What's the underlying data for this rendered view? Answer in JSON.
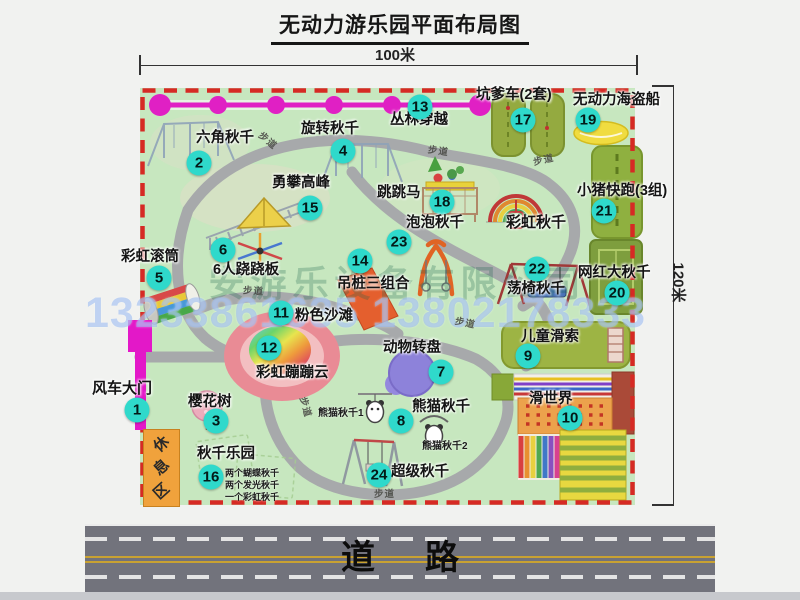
{
  "title": "无动力游乐园平面布局图",
  "dimensions": {
    "width": "100米",
    "height": "120米"
  },
  "watermark": {
    "company": "安游乐设备有限公司",
    "phone": "13233861635 13802178333"
  },
  "road_label": "道路",
  "trail_label_text": "步道",
  "rest_area_label": "休息区",
  "attractions": [
    {
      "num": 1,
      "label": "风车大门",
      "lx": -48,
      "ly": 293,
      "bx": -3,
      "by": 322,
      "ls": 15
    },
    {
      "num": 2,
      "label": "六角秋千",
      "lx": 56,
      "ly": 43,
      "bx": 59,
      "by": 75
    },
    {
      "num": 3,
      "label": "樱花树",
      "lx": 48,
      "ly": 307,
      "bx": 76,
      "by": 333
    },
    {
      "num": 4,
      "label": "旋转秋千",
      "lx": 161,
      "ly": 34,
      "bx": 203,
      "by": 63
    },
    {
      "num": 5,
      "label": "彩虹滚筒",
      "lx": -19,
      "ly": 162,
      "bx": 19,
      "by": 190
    },
    {
      "num": 6,
      "label": "6人跷跷板",
      "lx": 73,
      "ly": 175,
      "bx": 83,
      "by": 162
    },
    {
      "num": 7,
      "label": "动物转盘",
      "lx": 243,
      "ly": 253,
      "bx": 301,
      "by": 284
    },
    {
      "num": 8,
      "label": "熊猫秋千",
      "lx": 272,
      "ly": 312,
      "bx": 261,
      "by": 333
    },
    {
      "num": 9,
      "label": "儿童滑索",
      "lx": 381,
      "ly": 242,
      "bx": 388,
      "by": 268
    },
    {
      "num": 10,
      "label": "滑世界",
      "lx": 389,
      "ly": 304,
      "bx": 430,
      "by": 330
    },
    {
      "num": 11,
      "label": "粉色沙滩",
      "lx": 155,
      "ly": 221,
      "bx": 141,
      "by": 225
    },
    {
      "num": 12,
      "label": "彩虹蹦蹦云",
      "lx": 116,
      "ly": 278,
      "bx": 129,
      "by": 260
    },
    {
      "num": 13,
      "label": "丛林穿越",
      "lx": 250,
      "ly": 25,
      "bx": 280,
      "by": 19
    },
    {
      "num": 14,
      "label": "吊桩三组合",
      "lx": 197,
      "ly": 189,
      "bx": 220,
      "by": 173
    },
    {
      "num": 15,
      "label": "勇攀高峰",
      "lx": 132,
      "ly": 88,
      "bx": 170,
      "by": 120
    },
    {
      "num": 16,
      "label": "秋千乐园",
      "lx": 57,
      "ly": 359,
      "bx": 71,
      "by": 389
    },
    {
      "num": 17,
      "label": "坑爹车(2套)",
      "lx": 336,
      "ly": 0,
      "bx": 383,
      "by": 32
    },
    {
      "num": 18,
      "label": "跳跳马",
      "lx": 237,
      "ly": 98,
      "bx": 302,
      "by": 114
    },
    {
      "num": 19,
      "label": "无动力海盗船",
      "lx": 433,
      "ly": 5,
      "bx": 448,
      "by": 32
    },
    {
      "num": 20,
      "label": "网红大秋千",
      "lx": 438,
      "ly": 178,
      "bx": 477,
      "by": 205
    },
    {
      "num": 21,
      "label": "小猪快跑(3组)",
      "lx": 437,
      "ly": 96,
      "bx": 464,
      "by": 123
    },
    {
      "num": 22,
      "label": "荡椅秋千",
      "lx": 367,
      "ly": 194,
      "bx": 397,
      "by": 181
    },
    {
      "num": 23,
      "label": "泡泡秋千",
      "lx": 266,
      "ly": 128,
      "bx": 259,
      "by": 154
    },
    {
      "num": 24,
      "label": "超级秋千",
      "lx": 251,
      "ly": 377,
      "bx": 239,
      "by": 387
    }
  ],
  "extra_labels": [
    {
      "text": "彩虹秋千",
      "x": 366,
      "y": 127,
      "size": 15
    }
  ],
  "sub_labels": [
    {
      "text": "熊猫秋千1",
      "x": 178,
      "y": 316,
      "size": 10
    },
    {
      "text": "熊猫秋千2",
      "x": 282,
      "y": 349,
      "size": 10
    },
    {
      "text": "两个蝴蝶秋千",
      "x": 85,
      "y": 378,
      "size": 9
    },
    {
      "text": "两个发光秋千",
      "x": 85,
      "y": 390,
      "size": 9
    },
    {
      "text": "一个彩虹秋千",
      "x": 85,
      "y": 402,
      "size": 9
    }
  ],
  "trail_labels": [
    {
      "x": 118,
      "y": 45,
      "rot": 40
    },
    {
      "x": 288,
      "y": 55,
      "rot": 8
    },
    {
      "x": 393,
      "y": 64,
      "rot": -12
    },
    {
      "x": 103,
      "y": 195,
      "rot": 4
    },
    {
      "x": 315,
      "y": 227,
      "rot": 12
    },
    {
      "x": 156,
      "y": 312,
      "rot": 75
    },
    {
      "x": 234,
      "y": 398,
      "rot": 0
    }
  ]
}
